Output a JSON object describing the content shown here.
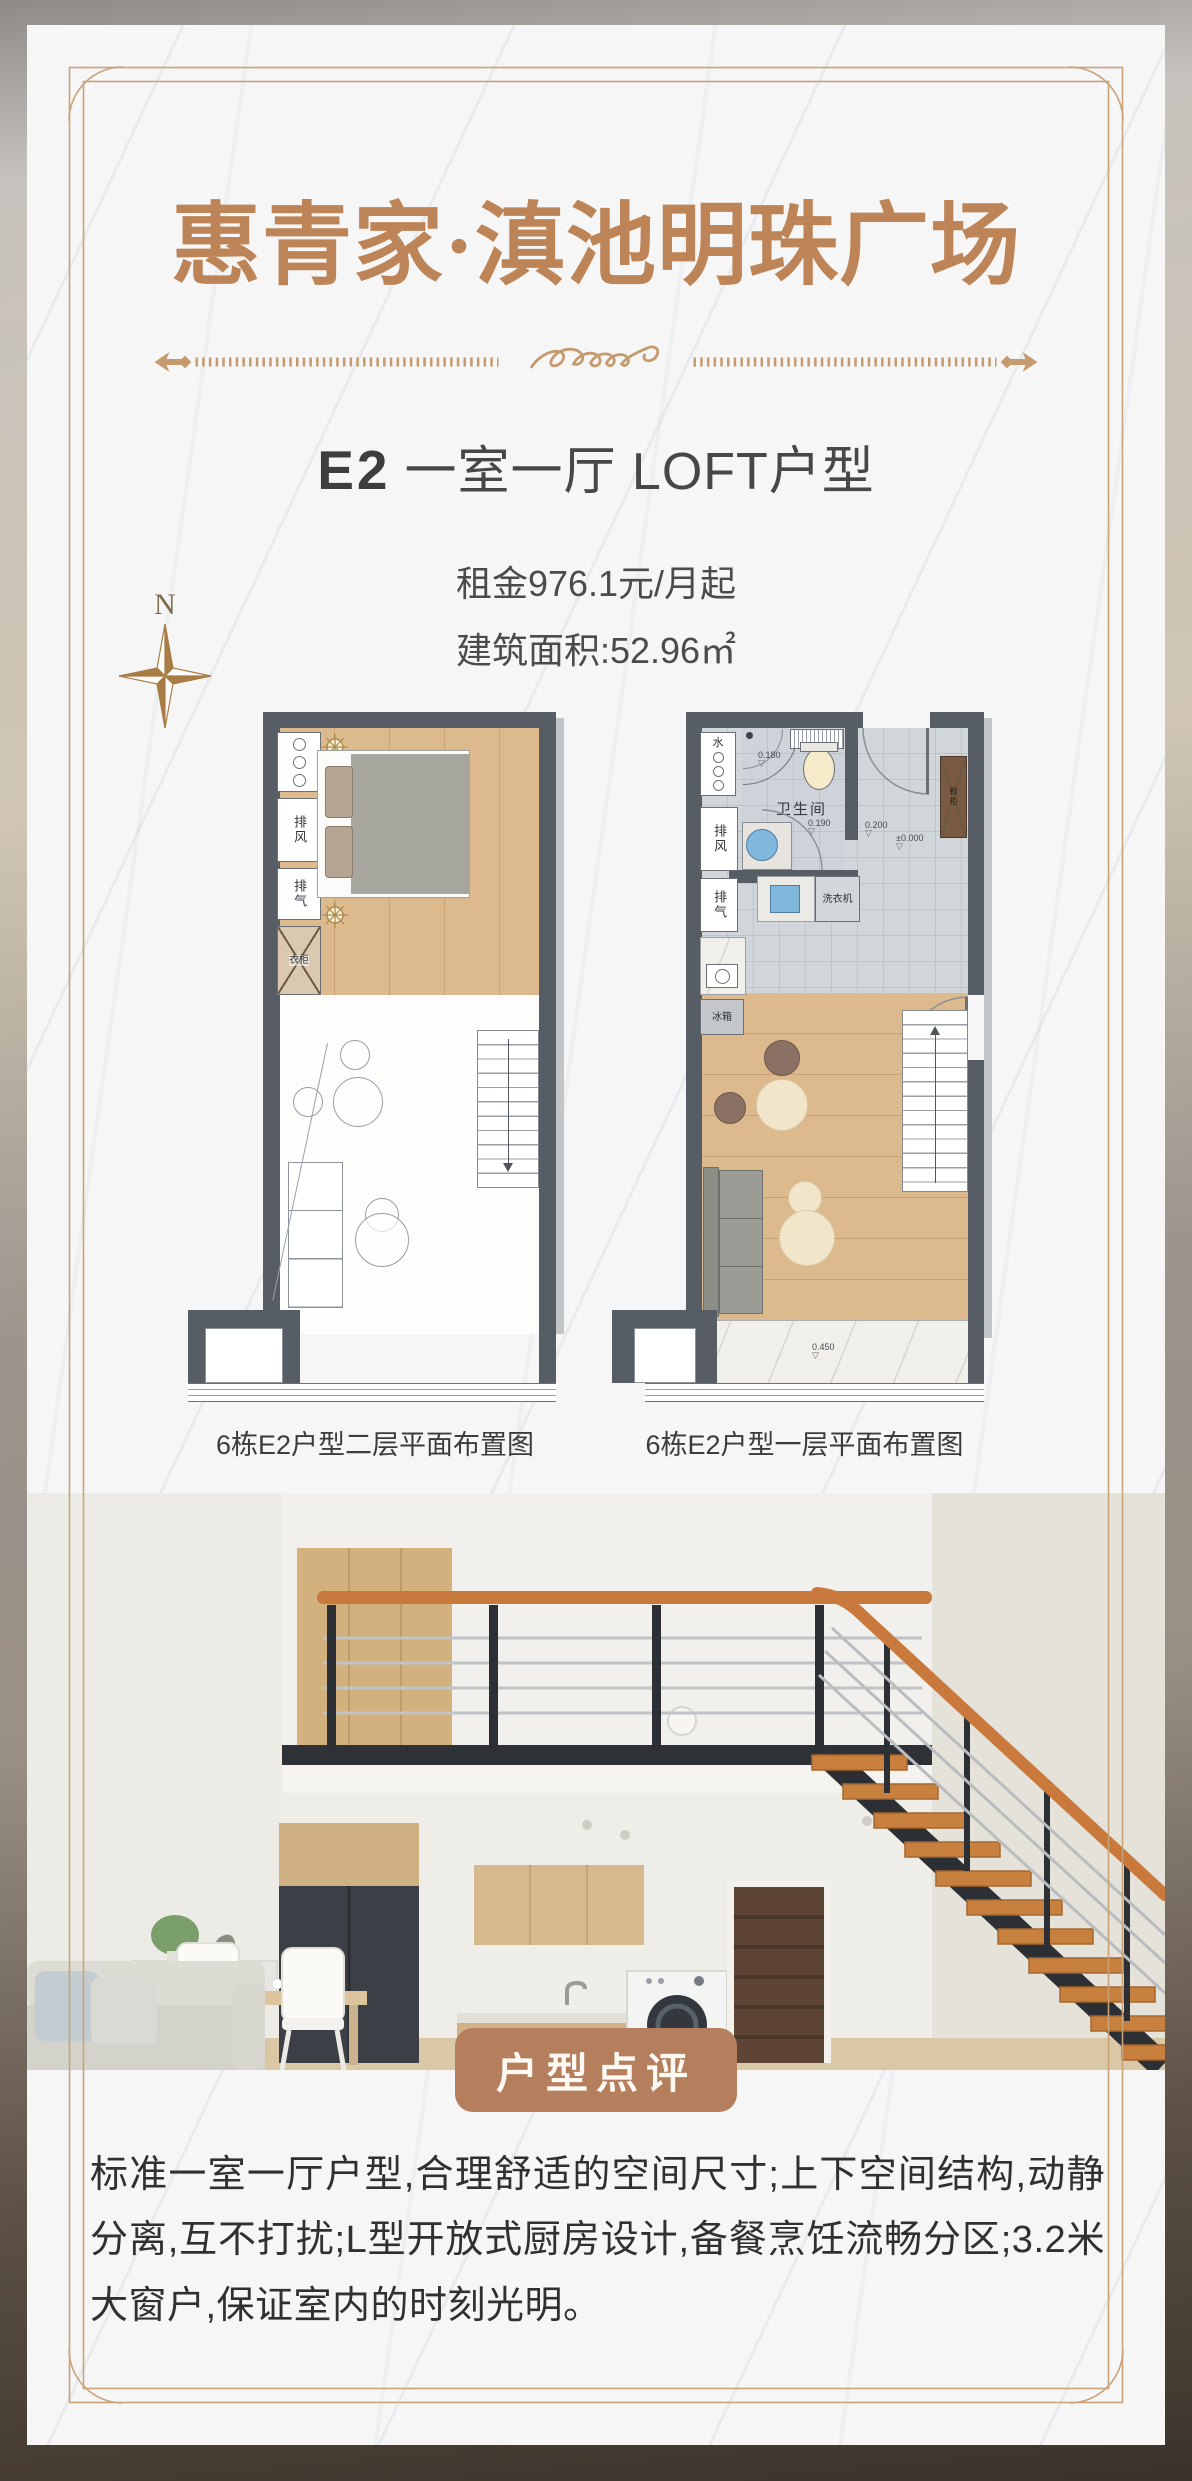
{
  "header": {
    "title": "惠青家·滇池明珠广场",
    "unit_code": "E2",
    "unit_desc": "一室一厅 LOFT户型",
    "rent": "租金976.1元/月起",
    "area": "建筑面积:52.96㎡",
    "compass_n": "N"
  },
  "plans": {
    "left": {
      "caption": "6栋E2户型二层平面布置图",
      "exhaust_air": "排风",
      "exhaust_gas": "排气",
      "wardrobe": "衣柜"
    },
    "right": {
      "caption": "6栋E2户型一层平面布置图",
      "water": "水",
      "exhaust_air": "排风",
      "exhaust_gas": "排气",
      "bathroom": "卫生间",
      "washer": "洗衣机",
      "fridge": "冰箱",
      "shoe_cabinet": "鞋柜",
      "elev_0180": "0.180",
      "elev_0190": "0.190",
      "elev_0200": "0.200",
      "elev_0000": "±0.000",
      "elev_0450": "0.450",
      "elev_mark": "▽"
    }
  },
  "photo": {
    "badge": "户型点评"
  },
  "review": {
    "text": "标准一室一厅户型,合理舒适的空间尺寸;上下空间结构,动静分离,互不打扰;L型开放式厨房设计,备餐烹饪流畅分区;3.2米大窗户,保证室内的时刻光明。"
  },
  "colors": {
    "accent_gold": "#bd8557",
    "badge_brown": "#b57f5e",
    "plan_wall": "#575d65",
    "wood_floor": "#dcba8e",
    "tile_floor": "#d1d6db"
  }
}
